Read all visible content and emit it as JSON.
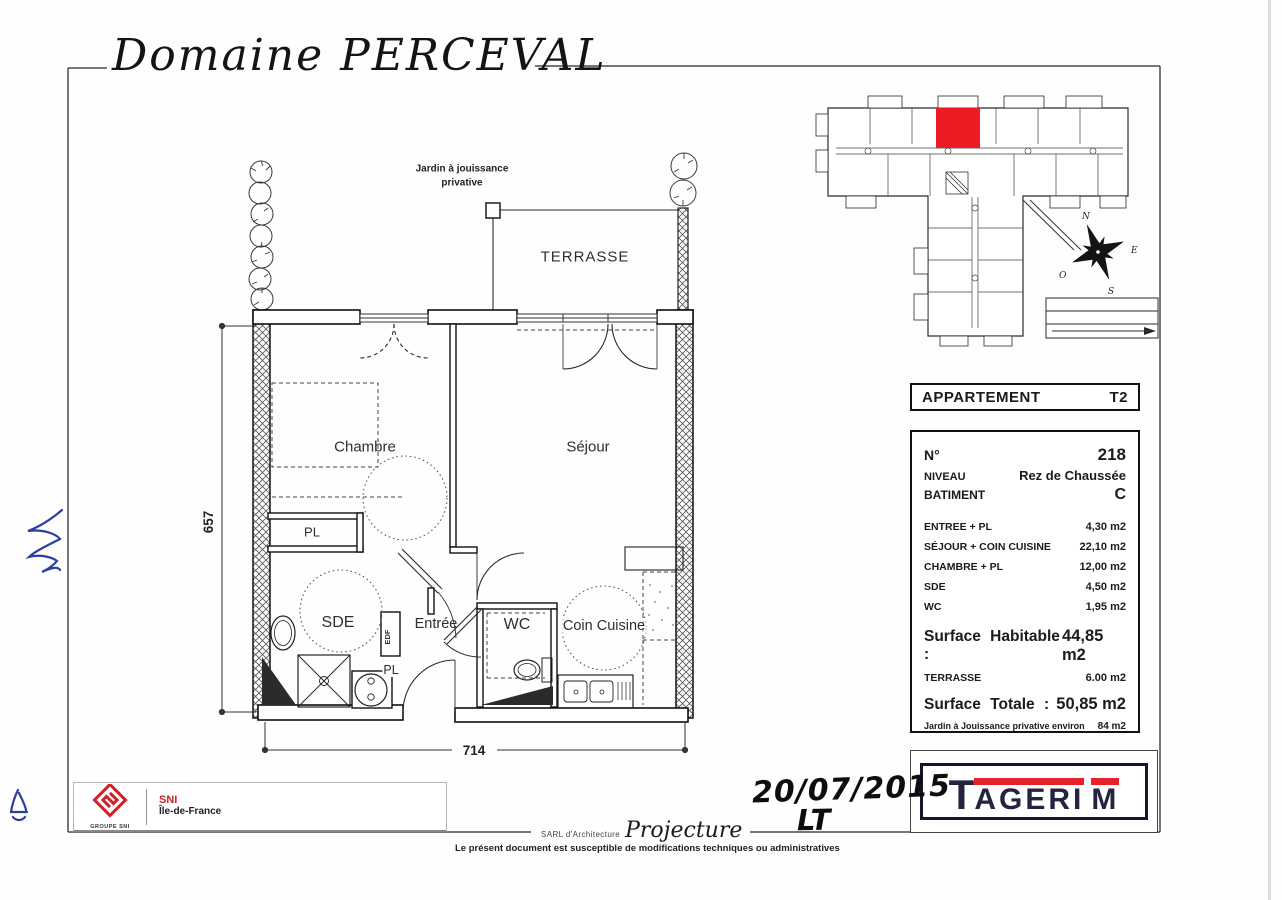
{
  "colors": {
    "accent_red": "#ed1c24",
    "tagerim_navy": "#23243f",
    "sni_red": "#d31f26",
    "ink_blue": "#2c3f9e"
  },
  "title": "Domaine PERCEVAL",
  "plan": {
    "jardin_label_1": "Jardin à jouissance",
    "jardin_label_2": "privative",
    "rooms": {
      "terrasse": "TERRASSE",
      "chambre": "Chambre",
      "sejour": "Séjour",
      "sde": "SDE",
      "entree": "Entrée",
      "wc": "WC",
      "coin_cuisine": "Coin Cuisine",
      "pl_chambre": "PL",
      "pl_entree": "PL",
      "edf": "EDF"
    },
    "dimensions": {
      "height": "657",
      "width": "714"
    }
  },
  "key_plan": {
    "compass": {
      "n": "N",
      "e": "E",
      "s": "S",
      "o": "O"
    }
  },
  "info_panel": {
    "header": {
      "label": "APPARTEMENT",
      "value": "T2"
    },
    "details": [
      {
        "label": "N°",
        "value": "218"
      },
      {
        "label": "NIVEAU",
        "value": "Rez de Chaussée"
      },
      {
        "label": "BATIMENT",
        "value": "C"
      }
    ],
    "areas": [
      {
        "label": "ENTREE + PL",
        "value": "4,30 m2"
      },
      {
        "label": "SÉJOUR + COIN CUISINE",
        "value": "22,10 m2"
      },
      {
        "label": "CHAMBRE + PL",
        "value": "12,00 m2"
      },
      {
        "label": "SDE",
        "value": "4,50 m2"
      },
      {
        "label": "WC",
        "value": "1,95 m2"
      }
    ],
    "surface_habitable": {
      "label": "Surface Habitable :",
      "value": "44,85 m2"
    },
    "terrasse": {
      "label": "TERRASSE",
      "value": "6.00 m2"
    },
    "surface_totale": {
      "label": "Surface Totale :",
      "value": "50,85 m2"
    },
    "jardin": {
      "label": "Jardin à Jouissance privative environ",
      "value": "84 m2"
    }
  },
  "branding": {
    "tagerim": {
      "t": "T",
      "mid": "AGERI",
      "m": "M"
    },
    "sni": {
      "group": "GROUPE SNI",
      "name": "SNI",
      "region": "Île-de-France"
    }
  },
  "annotations": {
    "date": "20/07/2015",
    "initials": "LT"
  },
  "footer": {
    "firm_prefix": "SARL d'Architecture",
    "firm_name": "Projecture",
    "disclaimer": "Le présent document est susceptible de modifications techniques ou administratives"
  }
}
